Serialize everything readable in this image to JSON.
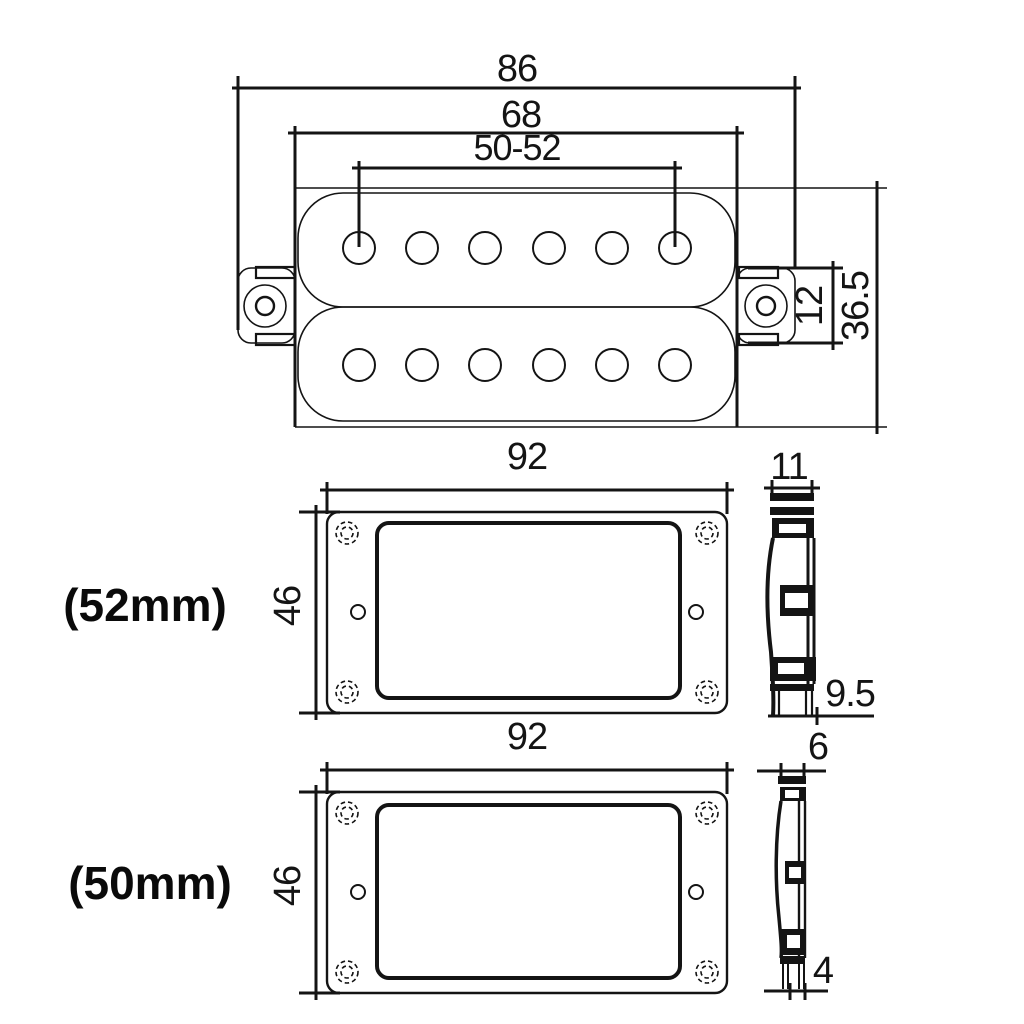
{
  "drawing": {
    "background": "#ffffff",
    "ink": "#141414",
    "top_view": {
      "overall_width": "86",
      "baseplate_width": "68",
      "pole_spacing": "50-52",
      "ear_height": "12",
      "overall_height": "36.5"
    },
    "ring_52mm": {
      "label": "(52mm)",
      "front": {
        "width": "92",
        "height": "46"
      },
      "side": {
        "width": "11",
        "base_height": "9.5"
      }
    },
    "ring_50mm": {
      "label": "(50mm)",
      "front": {
        "width": "92",
        "height": "46"
      },
      "side": {
        "width": "6",
        "base_height": "4"
      }
    }
  }
}
